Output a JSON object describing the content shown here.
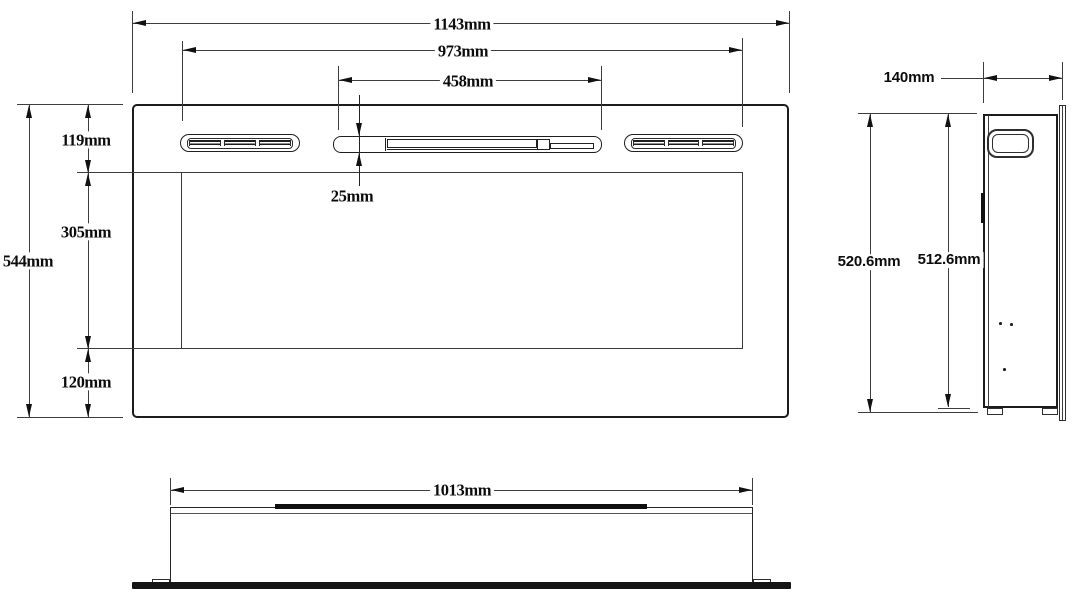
{
  "drawing": {
    "kind": "technical-dimension-drawing",
    "subject": "wall-mounted electric fireplace",
    "unit": "mm",
    "colors": {
      "line": "#1c1c1c",
      "background": "#ffffff"
    }
  },
  "front_view": {
    "overall_width": "1143mm",
    "grille_span_width": "973mm",
    "outlet_slot_width": "458mm",
    "outlet_slot_height": "25mm",
    "top_section_height": "119mm",
    "window_height": "305mm",
    "bottom_section_height": "120mm",
    "overall_height": "544mm"
  },
  "side_view": {
    "depth": "140mm",
    "overall_height": "520.6mm",
    "body_height": "512.6mm"
  },
  "bottom_view": {
    "recess_width": "1013mm"
  }
}
